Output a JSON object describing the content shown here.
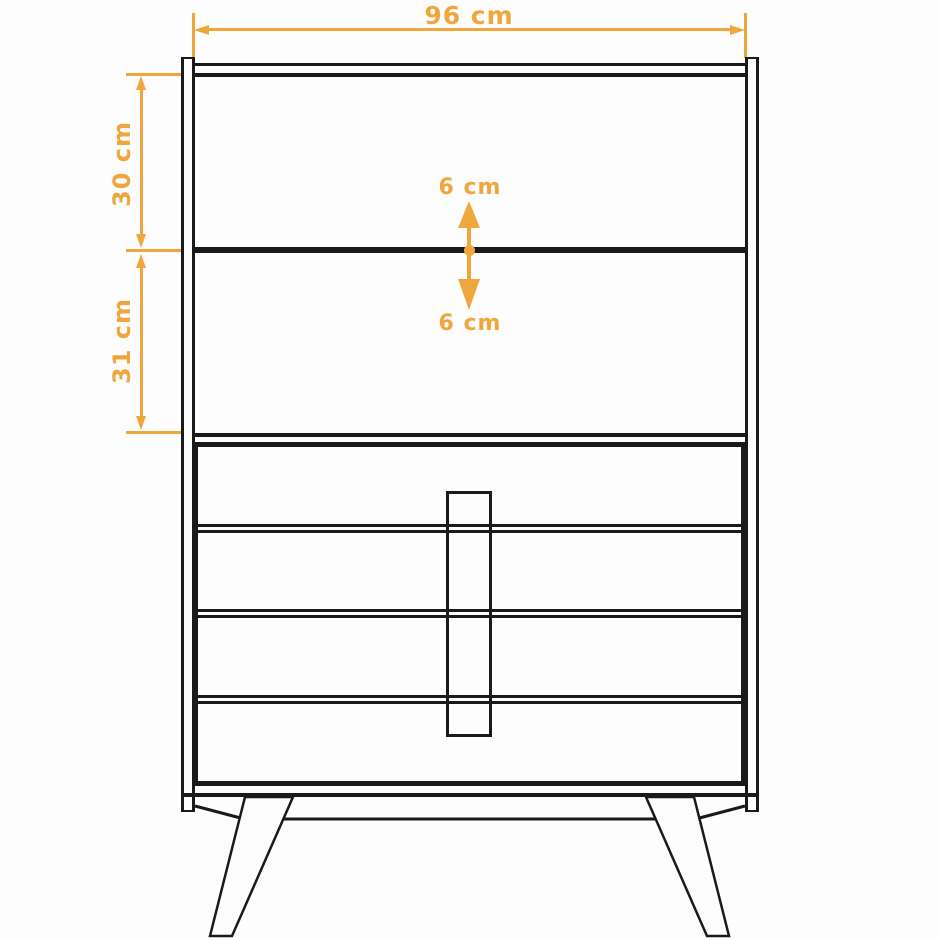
{
  "diagram": {
    "type": "furniture-dimension-drawing",
    "subject": "cabinet with upper shelf section and four drawers on splayed legs",
    "labels": {
      "width": "96 cm",
      "upper_section_height": "30 cm",
      "lower_section_height": "31 cm",
      "shelf_clearance_up": "6 cm",
      "shelf_clearance_down": "6 cm"
    },
    "colors": {
      "dimension_accent": "#EFA63C",
      "outline": "#1A1A1A",
      "background": "#FDFDFD"
    }
  }
}
